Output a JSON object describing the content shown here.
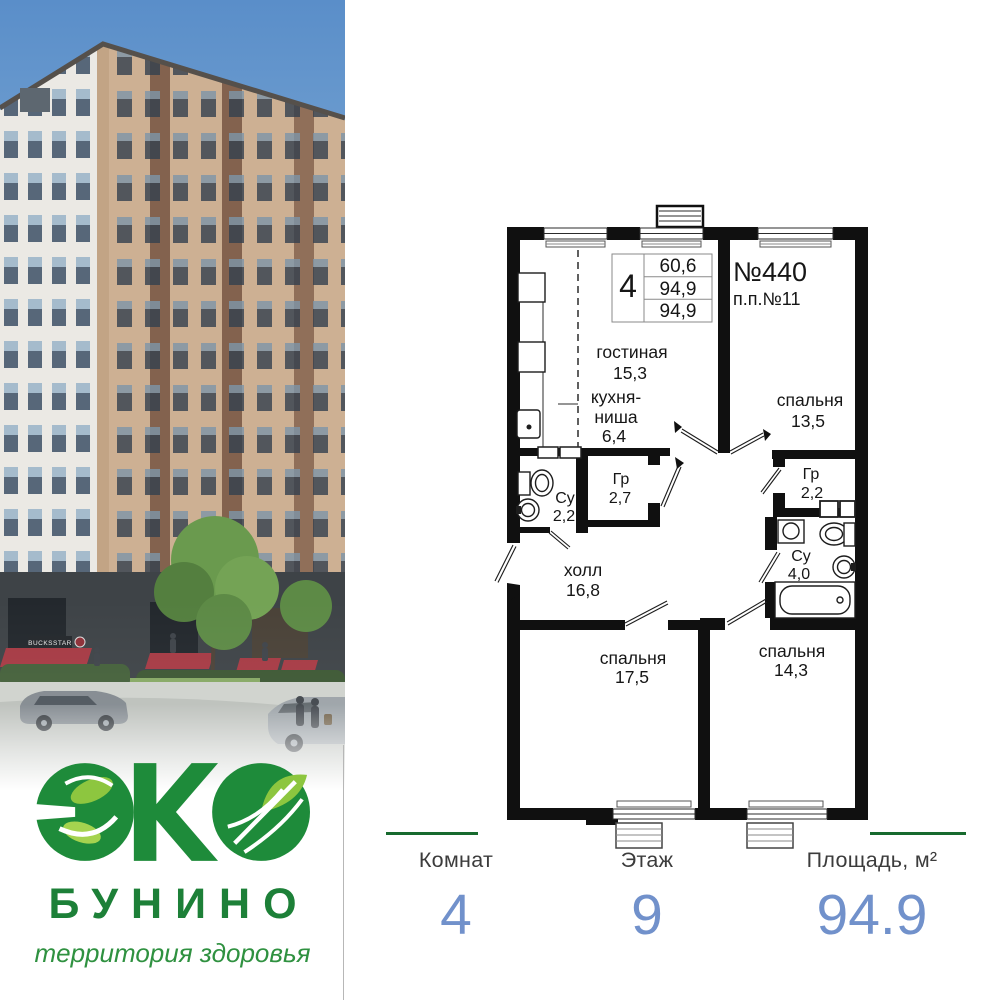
{
  "logo": {
    "emblem": "ЭКО",
    "brand": "БУНИНО",
    "tagline": "территория здоровья"
  },
  "photo": {
    "storefront_sign": "BUCKSSTAR"
  },
  "plan": {
    "info": {
      "rooms_count": "4",
      "area_rows": [
        "60,6",
        "94,9",
        "94,9"
      ]
    },
    "apt_no": "№440",
    "pp_no": "п.п.№11",
    "rooms": [
      {
        "name": "гостиная",
        "area": "15,3"
      },
      {
        "name": "кухня-",
        "name2": "ниша",
        "area": "6,4"
      },
      {
        "name": "спальня",
        "area": "13,5"
      },
      {
        "name": "Су",
        "area": "2,2"
      },
      {
        "name": "Гр",
        "area": "2,7"
      },
      {
        "name": "Гр",
        "area": "2,2"
      },
      {
        "name": "Су",
        "area": "4,0"
      },
      {
        "name": "холл",
        "area": "16,8"
      },
      {
        "name": "спальня",
        "area": "17,5"
      },
      {
        "name": "спальня",
        "area": "14,3"
      }
    ]
  },
  "summary": {
    "items": [
      {
        "label": "Комнат",
        "value": "4"
      },
      {
        "label": "Этаж",
        "value": "9"
      },
      {
        "label": "Площадь, м²",
        "value": "94.9"
      }
    ]
  },
  "colors": {
    "brand_green": "#1d8038",
    "light_green": "#8dc63f",
    "accent_blue": "#7191cb",
    "divider_green": "#176a2e",
    "wall_black": "#101010"
  }
}
